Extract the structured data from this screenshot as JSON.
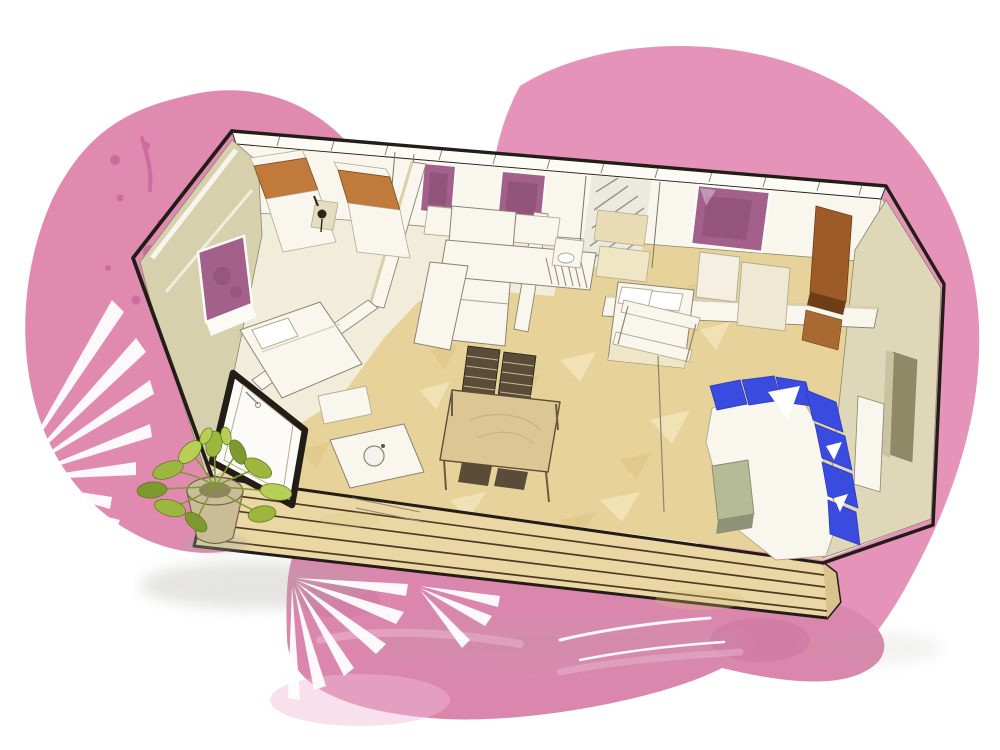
{
  "title": "Watercolor 3D cutaway floor plan of a two-bedroom mobile home with wooden deck terrace",
  "palette": {
    "bg": "#ffffff",
    "outline": "#221d16",
    "lineSoft": "#b4ab94",
    "lineMid": "#8c8472",
    "wallWhite": "#f9f6ee",
    "wallCream": "#f2edda",
    "wallKhaki": "#d7d0ad",
    "wallKhakiLight": "#e4ddc0",
    "wallBeigeFace": "#ded7b8",
    "floorTan": "#e7d399",
    "floorTanLight": "#f3e6bb",
    "floorTanDark": "#d9c17f",
    "deckWood": "#ead7a4",
    "deckWoodDark": "#d9c28c",
    "deckLine": "#4a3a24",
    "windowPurple": "#a2608a",
    "windowPurpleDark": "#84486d",
    "bedOrange": "#c07b3c",
    "sofaBlue": "#3a4be0",
    "sofaBlueDark": "#2d3bc0",
    "tableWood": "#dcc694",
    "chairDark": "#5a4c38",
    "oliveTable": "#b5bb97",
    "oliveTableDark": "#8e9377",
    "plantGreen": "#9cb63e",
    "plantGreenDark": "#7e9a2f",
    "plantGreenLight": "#b8cf55",
    "potTan": "#cabc97",
    "potDark": "#8f8266",
    "pinkBlob": "#e593b8",
    "pinkBlobLeft": "#e08ab0",
    "pinkSpot": "#c9659a",
    "roseBand": "#db87ad",
    "roseBandDark": "#c76b9b",
    "roseBandLight": "#f0bcd6",
    "nicheOlive": "#8e8a68",
    "wardrobeBrown": "#9d5c27",
    "wardrobeBrownDark": "#6e3f17",
    "shadowGrey": "#a9a7a2"
  },
  "scene": {
    "background": {
      "left_blob": "pink watercolor blob with darker splatter dots",
      "right_blob": "large flat pink blob behind roof and right side",
      "bottom_band": "darker rose watercolor wash under the deck",
      "foliage": "white palm frond silhouettes over the pink washes"
    },
    "building": {
      "style": "hand-drawn 3D cutaway seen from above-front",
      "rooms": [
        {
          "name": "twin-bedroom",
          "furniture": [
            "two single beds with orange covers",
            "small desk with black chair"
          ]
        },
        {
          "name": "left-bedroom",
          "furniture": [
            "double bed with white cover"
          ],
          "window": "purple window in gable wall"
        },
        {
          "name": "bathroom",
          "furniture": [
            "walk-in shower with bold black frame",
            "vanity with round basin"
          ]
        },
        {
          "name": "kitchen",
          "furniture": [
            "white counters with sink drainer",
            "tall cabinet column",
            "wall cabinets"
          ],
          "windows": "two small purple windows"
        },
        {
          "name": "master-bedroom",
          "furniture": [
            "double bed with white pillows",
            "brown wardrobe",
            "beige closets"
          ],
          "window": "large purple window"
        },
        {
          "name": "living-dining",
          "furniture": [
            "blue corner sofa with white seat",
            "olive coffee table",
            "wood dining table with woven chairs",
            "open shelf partition"
          ]
        }
      ],
      "exterior": [
        "wooden plank deck terrace",
        "potted green plant",
        "beige end wall with niche"
      ]
    }
  }
}
